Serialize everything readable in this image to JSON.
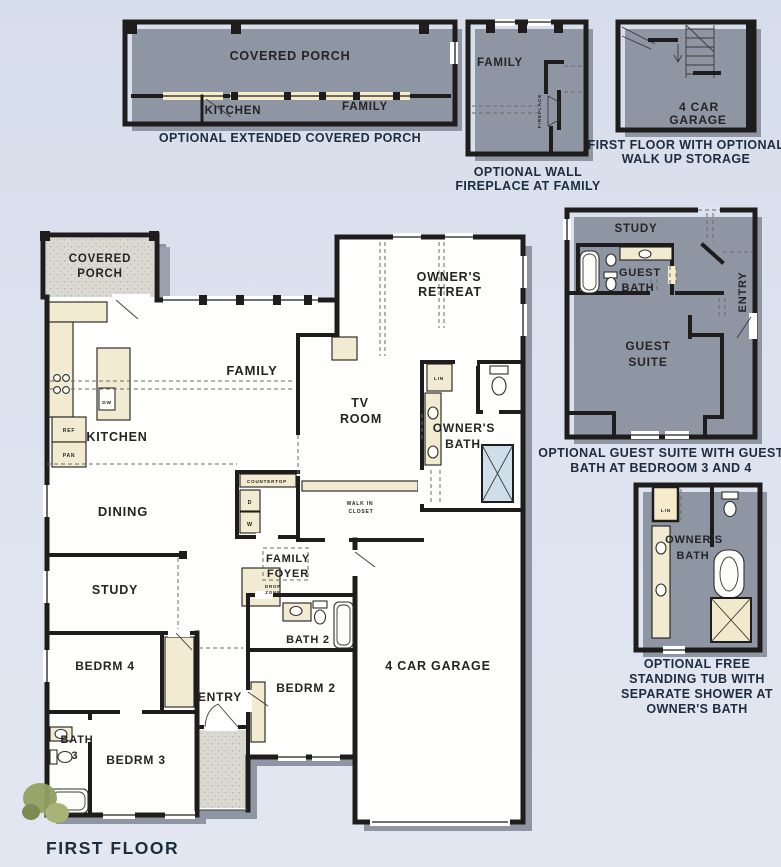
{
  "colors": {
    "background": "#dde3ef",
    "plan_cream": "#f7ecca",
    "wall": "#1e1d1b",
    "shadow": "#8f96a3",
    "caption_text": "#1d2c3e",
    "shower_blue": "#cfdfe9",
    "bush_green": "#93a061"
  },
  "insetPorch": {
    "caption": "OPTIONAL EXTENDED COVERED PORCH",
    "covered_porch": "COVERED PORCH",
    "kitchen": "KITCHEN",
    "family": "FAMILY"
  },
  "insetFireplace": {
    "caption_line1": "OPTIONAL WALL",
    "caption_line2": "FIREPLACE AT FAMILY",
    "family": "FAMILY",
    "fireplace": "FIREPLACE"
  },
  "insetStorage": {
    "caption_line1": "FIRST FLOOR WITH OPTIONAL",
    "caption_line2": "WALK UP STORAGE",
    "garage_line1": "4 CAR",
    "garage_line2": "GARAGE"
  },
  "insetGuest": {
    "caption_line1": "OPTIONAL GUEST SUITE WITH GUEST",
    "caption_line2": "BATH AT BEDROOM 3 AND 4",
    "study": "STUDY",
    "bath_line1": "GUEST",
    "bath_line2": "BATH",
    "entry": "ENTRY",
    "suite_line1": "GUEST",
    "suite_line2": "SUITE"
  },
  "insetTub": {
    "caption_line1": "OPTIONAL FREE",
    "caption_line2": "STANDING TUB WITH",
    "caption_line3": "SEPARATE SHOWER AT",
    "caption_line4": "OWNER'S BATH",
    "lin": "LIN",
    "bath_line1": "OWNER'S",
    "bath_line2": "BATH"
  },
  "main": {
    "covered_line1": "COVERED",
    "covered_line2": "PORCH",
    "family": "FAMILY",
    "retreat_line1": "OWNER'S",
    "retreat_line2": "RETREAT",
    "tv_line1": "TV",
    "tv_line2": "ROOM",
    "obath_line1": "OWNER'S",
    "obath_line2": "BATH",
    "lin": "LIN",
    "kitchen": "KITCHEN",
    "ref": "REF",
    "pan": "PAN",
    "dw": "DW",
    "dining": "DINING",
    "countertop": "COUNTERTOP",
    "d": "D",
    "w": "W",
    "closet_line1": "WALK IN",
    "closet_line2": "CLOSET",
    "foyer_line1": "FAMILY",
    "foyer_line2": "FOYER",
    "drop_line1": "DROP",
    "drop_line2": "ZONE",
    "study": "STUDY",
    "bath2": "BATH 2",
    "bedrm4": "BEDRM 4",
    "entry": "ENTRY",
    "bedrm2": "BEDRM 2",
    "bedrm3": "BEDRM 3",
    "bath3_line1": "BATH",
    "bath3_line2": "3",
    "garage": "4 CAR GARAGE"
  },
  "footer": {
    "title": "FIRST FLOOR"
  }
}
